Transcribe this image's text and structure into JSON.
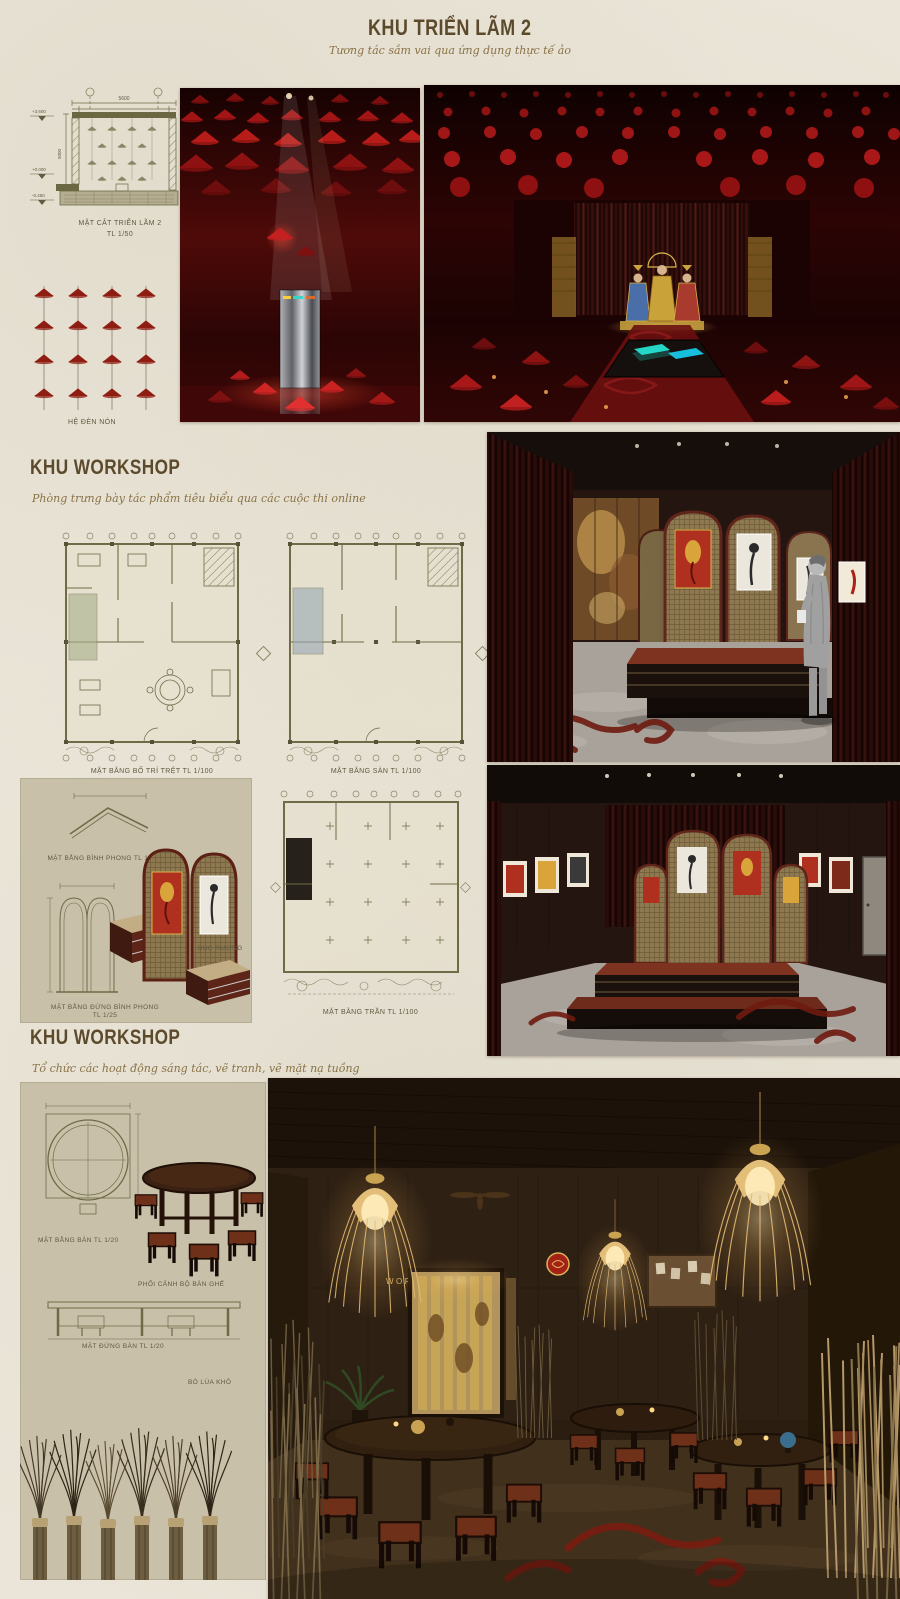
{
  "header": {
    "title": "KHU TRIỂN LÃM 2",
    "subtitle": "Tương tác sắm vai qua ứng dụng thực tế ảo"
  },
  "section_drawing": {
    "label": "MẶT CẮT TRIỂN LÃM 2",
    "scale": "TL 1/50",
    "dims": {
      "top": "5600",
      "inner": "4000",
      "height": "5000"
    },
    "levels": [
      "+3.600",
      "+0.000",
      "-0.450"
    ]
  },
  "lamp_diagram": {
    "label": "HỆ ĐÈN NÓN"
  },
  "workshop_gallery": {
    "title": "KHU WORKSHOP",
    "subtitle": "Phòng trưng bày tác phẩm tiêu biểu qua các cuộc thi online",
    "plan_ground_label": "MẶT BẰNG BỐ TRÍ TRỆT TL 1/100",
    "plan_floor_label": "MẶT BẰNG SÀN TL 1/100",
    "plan_ceiling_label": "MẶT BẰNG TRẦN TL 1/100",
    "screen_plan_label": "MẶT BẰNG BÌNH PHONG TL 1/25",
    "screen_elevation_label": "MẶT BẰNG ĐỨNG BÌNH PHONG",
    "screen_elevation_scale": "TL 1/25",
    "podium_label": "BỤC RƯƠNG"
  },
  "workshop_activity": {
    "title": "KHU WORKSHOP",
    "subtitle": "Tổ chức các hoạt động sáng tác, vẽ tranh, vẽ mặt nạ tuồng",
    "table_plan_label": "MẶT BẰNG BÀN TL 1/20",
    "table_perspective_label": "PHỐI CẢNH BỘ BÀN GHẾ",
    "table_elevation_label": "MẶT ĐỨNG BÀN TL 1/20",
    "dry_grass_label": "BÓ LÚA KHÔ",
    "sign": "WORKSHOP"
  },
  "colors": {
    "paper": "#eae5d8",
    "panel": "#c9c0a9",
    "accent_brown": "#5c4a2c",
    "script_gold": "#8a7246",
    "drawing_olive": "#6e6b47",
    "exhibition_red": "#a31515",
    "curtain_maroon": "#3c120d",
    "floor_grey": "#a8a29a",
    "cloud_red": "#6e1a10",
    "lamp_gold": "#e8c27a"
  }
}
